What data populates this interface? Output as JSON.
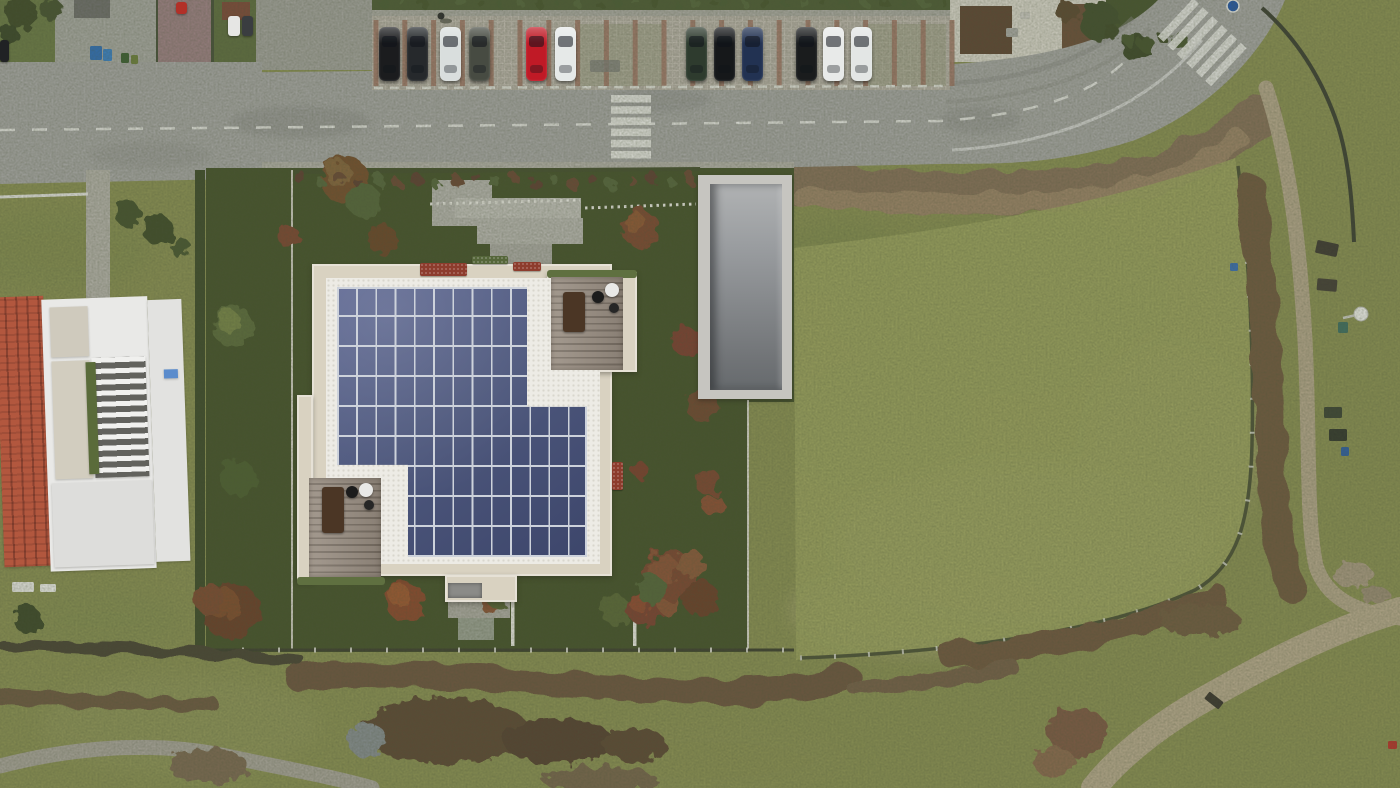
{
  "scene": {
    "w": 1400,
    "h": 788,
    "description": "aerial drone photo: new villa render with rooftop solar panels, street with parked cars and crosswalks above, neighbor house with terracotta roof at left, large mowed meadow with dirt footpaths at right, scrub hedgerows below"
  },
  "palette": {
    "grassBase": "#8a9054",
    "fieldGreen": "#9ca361",
    "renderLawn": "#46532c",
    "asphalt": "#a6a6a4",
    "sidewalk": "#aaa9a2",
    "paver": "#b6b0a7",
    "divider": "#9f7767",
    "cream": "#d9d2c1",
    "gravel": "#edebe5",
    "gravelDot": "#d9d6cd",
    "panel": "#4e587d",
    "panelHi": "#5b6590",
    "panelLo": "#3d466b",
    "panelGap": "#cdd2db",
    "deck": "#998e82",
    "deckLine": "#7a7065",
    "deckHedge": "#5f7040",
    "rampOuter": "#c6c5c0",
    "rampHi": "#b0b2b3",
    "rampLo": "#666a6d",
    "terracotta": "#b2573e",
    "terracottaDark": "#8a4230",
    "white": "#e9e9e7",
    "marking": "#e8e8e4",
    "scrub": "#6d573f",
    "hedgeDark": "#3f4c2c",
    "pathTan": "#b3a68b"
  },
  "base_rects": [
    [
      0,
      0,
      62,
      64,
      "#6b7a47",
      "garden-topleft"
    ],
    [
      55,
      0,
      112,
      66,
      "#a7a8a2",
      "pavement-topleft"
    ],
    [
      156,
      0,
      4,
      62,
      "#47513a",
      "hedge-line-a"
    ],
    [
      158,
      0,
      54,
      64,
      "#9c8084",
      "red-driveway"
    ],
    [
      211,
      0,
      4,
      62,
      "#47513a",
      "hedge-line-b"
    ],
    [
      214,
      0,
      44,
      62,
      "#5f6e41",
      "garden-b"
    ],
    [
      256,
      0,
      126,
      70,
      "#a2a29c",
      "pavement-b"
    ],
    [
      74,
      0,
      36,
      18,
      "#6f6f6d",
      "house-roof-gray"
    ],
    [
      222,
      2,
      28,
      18,
      "#7d4a3a",
      "house-roof-red"
    ],
    [
      950,
      0,
      160,
      62,
      "#d8d5cb",
      "gravel-courtyard"
    ],
    [
      960,
      6,
      52,
      48,
      "#5e4634",
      "shed-roof-a"
    ],
    [
      1062,
      4,
      46,
      54,
      "#6b4f3a",
      "shed-roof-b"
    ],
    [
      1106,
      0,
      80,
      70,
      "#47552f",
      "garden-in-curve"
    ]
  ],
  "road": {
    "shape": "M0,75 L940,65 C1055,58 1120,38 1158,0 L1285,0 C1262,55 1210,110 1135,140 C1050,168 980,163 940,164 L0,184 Z",
    "junction": [
      0,
      62,
      262,
      60
    ],
    "centerline": {
      "d": "M0,130 L940,121 C1040,114 1098,92 1132,54",
      "dash": "15 17"
    },
    "edgeline": {
      "d": "M952,150 C1060,144 1148,106 1202,40"
    },
    "tire": [
      [
        "M946,84 C1040,78 1098,54 1133,18",
        5,
        0.45
      ],
      [
        "M946,102 C1050,96 1112,68 1150,28",
        4,
        0.35
      ]
    ],
    "patches": [
      [
        300,
        122,
        70,
        16,
        "#8f8f8d",
        0.5
      ],
      [
        660,
        100,
        50,
        12,
        "#909090",
        0.45
      ],
      [
        150,
        155,
        60,
        14,
        "#949492",
        0.4
      ],
      [
        980,
        120,
        40,
        14,
        "#8d8d8b",
        0.4
      ]
    ]
  },
  "parking": {
    "apron": [
      372,
      16,
      578,
      74
    ],
    "hedge": [
      372,
      0,
      578,
      12
    ],
    "sidewalk": [
      372,
      10,
      578,
      8
    ],
    "dividers": {
      "x0": 376,
      "step": 28.8,
      "n": 21,
      "y0": 20,
      "y1": 86,
      "w": 5
    },
    "stall_line": "M374,88 L948,86",
    "moss": [
      [
        578,
        24,
        84,
        62
      ],
      [
        866,
        24,
        80,
        62
      ]
    ],
    "drain": [
      590,
      60,
      30,
      12
    ]
  },
  "cars": {
    "y": 27,
    "w": 21,
    "h": 54,
    "list": [
      [
        379,
        "#1b1c1e"
      ],
      [
        407,
        "#26292c"
      ],
      [
        440,
        "#d9dedd"
      ],
      [
        469,
        "#474b42"
      ],
      [
        526,
        "#c01a26"
      ],
      [
        555,
        "#e6e9e8"
      ],
      [
        686,
        "#2e3b2e"
      ],
      [
        714,
        "#16181a"
      ],
      [
        742,
        "#223252"
      ],
      [
        796,
        "#1a1c1d"
      ],
      [
        823,
        "#e8eae9"
      ],
      [
        851,
        "#e3e6e5"
      ]
    ],
    "extras": [
      [
        176,
        2,
        11,
        12,
        "#b23028"
      ],
      [
        228,
        16,
        12,
        20,
        "#e6e6e4"
      ],
      [
        242,
        16,
        11,
        20,
        "#3a3d40"
      ],
      [
        0,
        40,
        9,
        22,
        "#202224"
      ]
    ]
  },
  "crosswalks": {
    "straight": {
      "x": 611,
      "y": 95,
      "w": 40,
      "h": 7.5,
      "n": 6,
      "step": 11.2
    },
    "curve": {
      "x": 1204,
      "y": 44,
      "angle": -47,
      "n": 6,
      "len": 52,
      "t": 8,
      "step": 13
    }
  },
  "sign": {
    "cx": 1233,
    "cy": 6,
    "r": 6,
    "color": "#2457a8"
  },
  "field": {
    "d": "M794,248 C950,230 1100,206 1235,158 C1250,250 1256,350 1254,440 C1252,520 1240,560 1198,588 C1118,632 960,654 796,660 Z",
    "fence": "M800,658 C960,652 1110,630 1195,590 C1238,566 1250,520 1252,445 C1254,360 1250,262 1238,166"
  },
  "paths": [
    [
      "M1266,88 C1290,160 1300,250 1305,340 C1310,440 1306,520 1316,566 C1326,596 1352,612 1400,618",
      15,
      "#b3a68b",
      "footpath-east"
    ],
    [
      "M1400,610 C1330,630 1262,666 1196,704 C1152,730 1116,760 1094,788",
      26,
      "#b6a98d",
      "footpath-diagonal"
    ],
    [
      "M0,766 C70,748 152,740 226,756 C282,768 330,776 372,788",
      15,
      "#a8a49a",
      "footpath-southwest"
    ]
  ],
  "scrub_bank": [
    [
      "M792,184 C900,194 1005,196 1100,186 C1162,178 1222,150 1260,114",
      42,
      "#86715a"
    ],
    [
      "M800,196 C910,206 1010,206 1100,196 C1150,190 1200,168 1238,140",
      20,
      "#9b8468"
    ]
  ],
  "scrub_south": [
    [
      "M298,678 C430,666 570,690 720,692 C772,693 818,686 848,678",
      26,
      "#6d573f"
    ],
    [
      "M950,655 C1060,648 1150,625 1215,595",
      24,
      "#70593f"
    ],
    [
      "M1252,190 C1262,280 1268,380 1272,470 C1275,520 1280,560 1292,588",
      30,
      "#6f5a40"
    ],
    [
      "M0,643 C84,651 162,648 244,656 C272,659 290,659 300,661",
      11,
      "#4a4435"
    ],
    [
      "M0,696 C62,703 132,699 212,704",
      14,
      "#6d5a42"
    ],
    [
      "M856,688 C910,686 960,676 1010,666",
      16,
      "#75604a"
    ]
  ],
  "hedge_blobs": [
    [
      445,
      731,
      85,
      33,
      "#5d4936"
    ],
    [
      558,
      741,
      55,
      23,
      "#564330"
    ],
    [
      634,
      744,
      32,
      17,
      "#5d4936"
    ],
    [
      368,
      741,
      20,
      17,
      "#878e91"
    ],
    [
      208,
      766,
      40,
      18,
      "#7b6a52"
    ],
    [
      600,
      780,
      58,
      13,
      "#77664e"
    ],
    [
      1078,
      732,
      30,
      24,
      "#7d5a44"
    ],
    [
      1054,
      762,
      20,
      16,
      "#8a6a50"
    ],
    [
      1352,
      574,
      20,
      13,
      "#a89a82"
    ],
    [
      1375,
      595,
      14,
      10,
      "#9b8d76"
    ],
    [
      1200,
      620,
      40,
      16,
      "#715c42"
    ]
  ],
  "trees": [
    [
      345,
      180,
      24,
      "#74502f",
      "#8a6a42"
    ],
    [
      364,
      201,
      17,
      "#55663a",
      ""
    ],
    [
      383,
      240,
      15,
      "#6b462c",
      ""
    ],
    [
      289,
      237,
      11,
      "#7c4631",
      ""
    ],
    [
      233,
      326,
      21,
      "#5c6c3d",
      "#7e8c4d"
    ],
    [
      238,
      478,
      18,
      "#4e5f33",
      ""
    ],
    [
      231,
      611,
      29,
      "#6a3f2c",
      "#84512f"
    ],
    [
      209,
      599,
      15,
      "#7b4b33",
      ""
    ],
    [
      405,
      601,
      20,
      "#8a4a2f",
      "#a05c35"
    ],
    [
      489,
      604,
      9,
      "#8a5538",
      ""
    ],
    [
      497,
      596,
      12,
      "#5a6637",
      ""
    ],
    [
      615,
      610,
      15,
      "#5a6838",
      ""
    ],
    [
      645,
      607,
      19,
      "#7c4330",
      "#944f34"
    ],
    [
      668,
      604,
      11,
      "#8a5538",
      ""
    ],
    [
      640,
      228,
      19,
      "#7b4a31",
      "#935c38"
    ],
    [
      686,
      341,
      15,
      "#7b4030",
      ""
    ],
    [
      703,
      405,
      17,
      "#6f4a31",
      ""
    ],
    [
      708,
      482,
      13,
      "#7b4631",
      ""
    ],
    [
      714,
      506,
      11,
      "#8a5035",
      ""
    ],
    [
      670,
      575,
      26,
      "#7b4733",
      "#8f5638"
    ],
    [
      700,
      598,
      18,
      "#6a3f2c",
      ""
    ],
    [
      652,
      590,
      15,
      "#55663a",
      ""
    ],
    [
      690,
      563,
      14,
      "#8a5a3a",
      ""
    ],
    [
      640,
      470,
      8,
      "#7b3f2e",
      ""
    ],
    [
      22,
      14,
      16,
      "#3f4c2c",
      ""
    ],
    [
      52,
      10,
      11,
      "#465331",
      ""
    ],
    [
      10,
      34,
      9,
      "#3a4629",
      ""
    ],
    [
      1100,
      22,
      20,
      "#42502e",
      ""
    ],
    [
      1136,
      48,
      14,
      "#3c4a2b",
      ""
    ],
    [
      1068,
      12,
      11,
      "#5c4a30",
      ""
    ],
    [
      128,
      214,
      13,
      "#44522e",
      ""
    ],
    [
      158,
      230,
      15,
      "#3f4e2b",
      ""
    ],
    [
      181,
      248,
      10,
      "#4a5833",
      ""
    ],
    [
      28,
      620,
      14,
      "#3d4a2b",
      ""
    ]
  ],
  "shrub_rows": [
    {
      "x0": 300,
      "x1": 690,
      "y": 181,
      "n": 21,
      "r": 6,
      "jit": 4,
      "colors": [
        "#5d3f30",
        "#56663c",
        "#6b4a35"
      ]
    },
    {
      "x0": 384,
      "x1": 714,
      "y": 5,
      "n": 18,
      "r": 5,
      "jit": 2,
      "colors": [
        "#4c5c35",
        "#55663c",
        "#46542f"
      ]
    },
    {
      "x0": 724,
      "x1": 944,
      "y": 5,
      "n": 12,
      "r": 5,
      "jit": 2,
      "colors": [
        "#4c5c35",
        "#55663c",
        "#46542f"
      ]
    },
    {
      "x0": 1112,
      "x1": 1180,
      "y": 40,
      "n": 5,
      "r": 8,
      "jit": 6,
      "colors": [
        "#3f4c2c",
        "#4a5833",
        "#44522e"
      ]
    }
  ],
  "render": {
    "lawn": "M206,168 L794,168 L794,402 L748,402 L748,652 L206,652 Z",
    "sidewalk": [
      262,
      162,
      532,
      9,
      "#b2b0a8"
    ],
    "west_hedge": [
      195,
      170,
      10,
      480,
      "#3f4c2c"
    ],
    "pads": [
      [
        432,
        180,
        60,
        46,
        "#b5b4ae"
      ],
      [
        455,
        198,
        126,
        20,
        "#c1c0ba"
      ],
      [
        477,
        218,
        106,
        26,
        "#b7b6b0"
      ],
      [
        490,
        244,
        62,
        20,
        "#acaba5"
      ],
      [
        448,
        602,
        62,
        16,
        "#adaba3"
      ],
      [
        458,
        618,
        36,
        22,
        "#9aa092"
      ],
      [
        86,
        170,
        24,
        128,
        "#b4b2aa"
      ]
    ],
    "dividers": [
      [
        511,
        599,
        3.5,
        47
      ],
      [
        633,
        597,
        3.5,
        49
      ]
    ],
    "trellis": [
      "M430,204 L580,200",
      "M585,208 L696,204"
    ],
    "fences": [
      {
        "d": "M292,170 L292,650",
        "c": "#cfcdc3",
        "w": 2,
        "posts": false
      },
      {
        "d": "M748,400 L748,650",
        "c": "#d8d6cc",
        "w": 2,
        "posts": false
      },
      {
        "d": "M206,650 L794,650",
        "c": "#3e4030",
        "w": 3,
        "posts": true
      },
      {
        "d": "M294,172 L700,169",
        "c": "#45502f",
        "w": 4,
        "posts": false
      },
      {
        "d": "M0,197 L88,194",
        "c": "#e4e4e0",
        "w": 3,
        "posts": false
      },
      {
        "d": "M1262,8 C1296,38 1322,78 1338,126 C1348,158 1352,196 1354,242",
        "c": "#3c4033",
        "w": 4,
        "posts": false
      }
    ]
  },
  "ramp": {
    "outer": [
      698,
      175,
      94,
      224
    ],
    "inner": [
      710,
      184,
      72,
      206
    ]
  },
  "building": {
    "rects": [
      [
        312,
        264,
        300,
        312,
        "roof-main"
      ],
      [
        297,
        395,
        16,
        187,
        "roof-wing-west"
      ],
      [
        547,
        272,
        90,
        100,
        "roof-terrace-block"
      ],
      [
        445,
        575,
        72,
        27,
        "roof-entrance-bump"
      ]
    ],
    "gravel": [
      326,
      278,
      274,
      286
    ],
    "planters": [
      [
        420,
        263,
        47,
        13,
        "#8d3c2d",
        "planter-red-a"
      ],
      [
        513,
        262,
        28,
        9,
        "#8d3c2d",
        "planter-red-b"
      ],
      [
        472,
        256,
        36,
        8,
        "#55663a",
        "planter-green"
      ],
      [
        612,
        462,
        11,
        28,
        "#8d3c2d",
        "planter-red-east"
      ]
    ],
    "entrance_pad": [
      448,
      583,
      34,
      15,
      "#8b8b88"
    ],
    "solar": {
      "x": 337,
      "y": 287,
      "w": 250,
      "h": 270,
      "cols": 13,
      "rows": 9,
      "clip": "polygon(0% 0%,76% 0%,76% 44.4%,100% 44.4%,100% 100%,28.4% 100%,28.4% 65.9%,0% 65.9%)"
    },
    "decks": [
      {
        "x": 551,
        "y": 277,
        "w": 72,
        "h": 93,
        "hedge": [
          547,
          270,
          90,
          8
        ],
        "furn": [
          [
            "r",
            563,
            292,
            22,
            40,
            "#4b3625"
          ],
          [
            "c",
            598,
            297,
            6,
            "#1c1c1c"
          ],
          [
            "c",
            612,
            290,
            7,
            "#e9e9e7"
          ],
          [
            "c",
            614,
            308,
            5,
            "#262626"
          ]
        ]
      },
      {
        "x": 309,
        "y": 478,
        "w": 72,
        "h": 99,
        "hedge": [
          297,
          577,
          88,
          8
        ],
        "furn": [
          [
            "r",
            322,
            487,
            22,
            46,
            "#4b3625"
          ],
          [
            "c",
            366,
            490,
            7,
            "#e9e9e7"
          ],
          [
            "c",
            352,
            492,
            6,
            "#1c1c1c"
          ],
          [
            "c",
            369,
            505,
            5,
            "#262626"
          ]
        ]
      }
    ]
  },
  "left_building": {
    "x": 0,
    "y": 286,
    "w": 190,
    "h": 298,
    "rot": -2,
    "parts": [
      [
        0,
        8,
        48,
        270,
        "tile",
        "terracotta-roof"
      ],
      [
        46,
        12,
        106,
        272,
        "#e9e9e7",
        "white-villa-body"
      ],
      [
        54,
        20,
        38,
        50,
        "#cfcabd",
        "upper-gravel-court"
      ],
      [
        54,
        74,
        38,
        118,
        "#d2cdbf",
        "gravel-courtyard"
      ],
      [
        94,
        72,
        54,
        120,
        "pergola",
        "pergola-beams"
      ],
      [
        88,
        76,
        10,
        112,
        "#5a6b3a",
        "shrub-column"
      ],
      [
        50,
        196,
        100,
        84,
        "#dddddb",
        "lower-terrace"
      ],
      [
        152,
        16,
        34,
        262,
        "#e2e2e0",
        "east-wing"
      ],
      [
        166,
        86,
        14,
        9,
        "#5b8ccc",
        "blue-tarp"
      ]
    ]
  },
  "patches": [
    [
      1020,
      540,
      190,
      80,
      "#b7b184",
      0.55
    ],
    [
      930,
      610,
      140,
      45,
      "#b2ac7e",
      0.5
    ],
    [
      1170,
      450,
      90,
      110,
      "#aaa676",
      0.45
    ],
    [
      1000,
      300,
      150,
      75,
      "#77854b",
      0.5
    ],
    [
      880,
      430,
      80,
      55,
      "#7d8a50",
      0.45
    ],
    [
      840,
      250,
      60,
      30,
      "#7a874d",
      0.4
    ],
    [
      60,
      250,
      90,
      40,
      "#7e8a50",
      0.4
    ],
    [
      100,
      620,
      80,
      30,
      "#828e52",
      0.4
    ],
    [
      180,
      725,
      140,
      50,
      "#949a60",
      0.45
    ],
    [
      700,
      760,
      150,
      40,
      "#8d9257",
      0.4
    ],
    [
      1320,
      700,
      80,
      40,
      "#8f9154",
      0.35
    ]
  ],
  "objects": {
    "furniture": [
      [
        1316,
        242,
        22,
        13,
        "#3e3a33",
        12,
        "bench"
      ],
      [
        1317,
        279,
        20,
        12,
        "#443f37",
        5,
        "bench"
      ],
      [
        1324,
        407,
        18,
        11,
        "#3c4435",
        0,
        "bench"
      ],
      [
        1329,
        429,
        18,
        12,
        "#33382e",
        0,
        "bench"
      ],
      [
        1205,
        696,
        18,
        9,
        "#3a362f",
        38,
        "log-on-path"
      ],
      [
        12,
        582,
        22,
        10,
        "#e6e6e2",
        0,
        "garden-table"
      ],
      [
        40,
        584,
        16,
        8,
        "#eeeeea",
        0,
        "garden-table"
      ],
      [
        1388,
        741,
        9,
        8,
        "#b8352c",
        0,
        "red-object"
      ],
      [
        1006,
        28,
        12,
        9,
        "#a9a9a5",
        0,
        "courtyard-item"
      ],
      [
        1020,
        12,
        10,
        7,
        "#c8c6c0",
        0,
        "courtyard-item"
      ]
    ],
    "bins": [
      [
        90,
        46,
        12,
        14,
        "#2f6fb8"
      ],
      [
        103,
        49,
        9,
        12,
        "#3a80c4"
      ],
      [
        121,
        53,
        8,
        10,
        "#3c5f33"
      ],
      [
        131,
        55,
        7,
        9,
        "#6d7f3d"
      ],
      [
        1338,
        322,
        10,
        11,
        "#3f6f62"
      ],
      [
        1341,
        447,
        8,
        9,
        "#2e5fa3"
      ],
      [
        1230,
        263,
        8,
        8,
        "#3a6fb5"
      ]
    ],
    "lamp": {
      "cx": 1361,
      "cy": 314,
      "r": 7,
      "poleX": 1343,
      "poleY": 318
    },
    "pedestrian": {
      "x": 441,
      "y": 16
    }
  }
}
